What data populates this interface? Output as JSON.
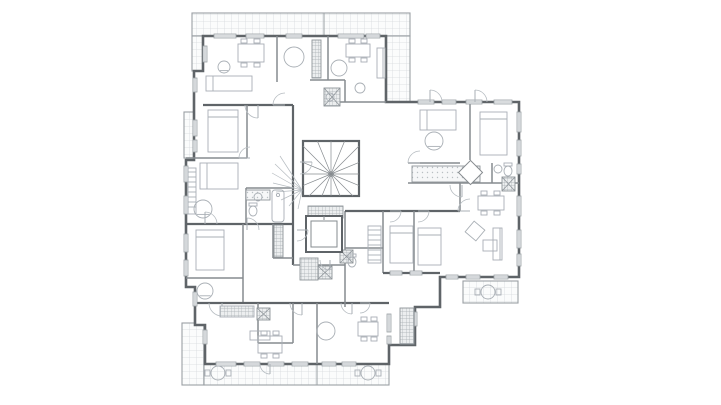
{
  "meta": {
    "title": "Residential apartment building floor plan",
    "drawing_type": "architectural-floor-plan",
    "visible_text": []
  },
  "canvas": {
    "width": 721,
    "height": 405,
    "background": "#ffffff"
  },
  "colors": {
    "outer_wall": "#5f6468",
    "inner_wall": "#868b8f",
    "light_line": "#b6bcc1",
    "furniture": "#a9afb5",
    "hatch_line": "#d6dadd",
    "hatch_border": "#9aa0a4",
    "dark_tile": "#8f959a",
    "window_fill": "#eef1f2",
    "background": "#ffffff"
  },
  "plan": {
    "envelope": [
      [
        203,
        36
      ],
      [
        386,
        36
      ],
      [
        386,
        102
      ],
      [
        519,
        102
      ],
      [
        519,
        277
      ],
      [
        440,
        277
      ],
      [
        440,
        307
      ],
      [
        415,
        307
      ],
      [
        415,
        345
      ],
      [
        389,
        345
      ],
      [
        389,
        364
      ],
      [
        205,
        364
      ],
      [
        205,
        325
      ],
      [
        195,
        325
      ],
      [
        195,
        287
      ],
      [
        186,
        287
      ],
      [
        186,
        160
      ],
      [
        194,
        160
      ],
      [
        194,
        71
      ],
      [
        203,
        71
      ]
    ],
    "terraces": [
      {
        "x": 192,
        "y": 13,
        "w": 218,
        "h": 23,
        "name": "roof-terrace-top"
      },
      {
        "x": 386,
        "y": 36,
        "w": 24,
        "h": 66,
        "name": "roof-terrace-top-right"
      },
      {
        "x": 192,
        "y": 36,
        "w": 11,
        "h": 35,
        "name": "terrace-left-upper"
      },
      {
        "x": 184,
        "y": 112,
        "w": 10,
        "h": 46,
        "name": "terrace-left-mid"
      },
      {
        "x": 182,
        "y": 323,
        "w": 22,
        "h": 62,
        "name": "terrace-bottom-left"
      },
      {
        "x": 204,
        "y": 364,
        "w": 185,
        "h": 21,
        "name": "terrace-bottom"
      },
      {
        "x": 463,
        "y": 281,
        "w": 55,
        "h": 22,
        "name": "balcony-right-wing"
      }
    ],
    "terrace_dividers": [
      [
        324,
        13,
        324,
        36
      ],
      [
        317,
        364,
        317,
        385
      ]
    ],
    "inner_walls": [
      {
        "s": [
          277,
          36,
          277,
          82
        ]
      },
      {
        "s": [
          328,
          36,
          328,
          80
        ]
      },
      {
        "s": [
          310,
          80,
          345,
          80
        ]
      },
      {
        "s": [
          345,
          80,
          345,
          102
        ]
      },
      {
        "s": [
          335,
          102,
          386,
          102
        ]
      },
      {
        "s": [
          203,
          105,
          293,
          105
        ],
        "t": 2.2
      },
      {
        "s": [
          247,
          105,
          247,
          158
        ]
      },
      {
        "s": [
          186,
          158,
          247,
          158
        ]
      },
      {
        "s": [
          293,
          105,
          293,
          265
        ],
        "t": 2.2
      },
      {
        "s": [
          186,
          224,
          293,
          224
        ],
        "t": 2.2
      },
      {
        "s": [
          246,
          188,
          246,
          224
        ]
      },
      {
        "s": [
          246,
          188,
          293,
          188
        ]
      },
      {
        "s": [
          273,
          224,
          273,
          258
        ]
      },
      {
        "s": [
          273,
          258,
          293,
          258
        ]
      },
      {
        "s": [
          243,
          224,
          243,
          303
        ]
      },
      {
        "s": [
          186,
          278,
          243,
          278
        ]
      },
      {
        "s": [
          195,
          303,
          389,
          303
        ],
        "t": 2.2
      },
      {
        "s": [
          317,
          303,
          317,
          364
        ]
      },
      {
        "s": [
          258,
          303,
          258,
          343
        ]
      },
      {
        "s": [
          258,
          343,
          293,
          343
        ]
      },
      {
        "s": [
          293,
          303,
          293,
          343
        ]
      },
      {
        "s": [
          345,
          211,
          345,
          307
        ]
      },
      {
        "s": [
          293,
          265,
          345,
          265
        ]
      },
      {
        "s": [
          345,
          211,
          460,
          211
        ],
        "t": 2.2
      },
      {
        "s": [
          460,
          183,
          460,
          211
        ]
      },
      {
        "s": [
          408,
          163,
          460,
          163
        ]
      },
      {
        "s": [
          408,
          183,
          519,
          183
        ]
      },
      {
        "s": [
          492,
          163,
          492,
          183
        ]
      },
      {
        "s": [
          470,
          102,
          470,
          160
        ]
      },
      {
        "s": [
          414,
          211,
          414,
          273
        ]
      },
      {
        "s": [
          383,
          211,
          383,
          273
        ]
      },
      {
        "s": [
          383,
          273,
          440,
          273
        ],
        "t": 2.2
      },
      {
        "s": [
          345,
          248,
          383,
          248
        ]
      }
    ],
    "stair": {
      "x": 303,
      "y": 141,
      "w": 56,
      "h": 55,
      "hubx": 331,
      "huby": 174,
      "steps": 16
    },
    "sketch_fan": {
      "from": [
        302,
        190
      ],
      "to": [
        [
          280,
          156
        ],
        [
          275,
          164
        ],
        [
          272,
          173
        ],
        [
          273,
          183
        ],
        [
          276,
          192
        ],
        [
          281,
          200
        ],
        [
          289,
          206
        ],
        [
          298,
          209
        ]
      ]
    },
    "elevator": {
      "x": 306,
      "y": 216,
      "w": 36,
      "h": 36,
      "inset": 5
    },
    "windows": [
      [
        214,
        34,
        22,
        4
      ],
      [
        246,
        34,
        18,
        4
      ],
      [
        286,
        34,
        16,
        4
      ],
      [
        338,
        34,
        26,
        4
      ],
      [
        366,
        34,
        14,
        4
      ],
      [
        418,
        100,
        16,
        4
      ],
      [
        442,
        100,
        14,
        4
      ],
      [
        466,
        100,
        16,
        4
      ],
      [
        494,
        100,
        18,
        4
      ],
      [
        517,
        112,
        4,
        20
      ],
      [
        517,
        140,
        4,
        16
      ],
      [
        517,
        164,
        4,
        10
      ],
      [
        517,
        196,
        4,
        20
      ],
      [
        517,
        230,
        4,
        18
      ],
      [
        517,
        254,
        4,
        12
      ],
      [
        446,
        275,
        12,
        4
      ],
      [
        466,
        275,
        14,
        4
      ],
      [
        494,
        275,
        14,
        4
      ],
      [
        390,
        271,
        12,
        4
      ],
      [
        410,
        271,
        12,
        4
      ],
      [
        216,
        362,
        20,
        4
      ],
      [
        244,
        362,
        16,
        4
      ],
      [
        268,
        362,
        16,
        4
      ],
      [
        292,
        362,
        16,
        4
      ],
      [
        322,
        362,
        14,
        4
      ],
      [
        342,
        362,
        14,
        4
      ],
      [
        184,
        166,
        4,
        16
      ],
      [
        184,
        196,
        4,
        18
      ],
      [
        184,
        234,
        4,
        18
      ],
      [
        184,
        260,
        4,
        16
      ],
      [
        193,
        292,
        4,
        14
      ],
      [
        193,
        78,
        4,
        14
      ],
      [
        193,
        120,
        4,
        16
      ],
      [
        193,
        140,
        4,
        12
      ],
      [
        203,
        330,
        4,
        14
      ],
      [
        203,
        46,
        4,
        16
      ],
      [
        387,
        314,
        4,
        18
      ],
      [
        387,
        336,
        4,
        8
      ],
      [
        413,
        312,
        4,
        14
      ]
    ],
    "dark_tiles": [
      {
        "x": 312,
        "y": 40,
        "w": 9,
        "h": 38
      },
      {
        "x": 324,
        "y": 88,
        "w": 16,
        "h": 18,
        "cross": true
      },
      {
        "x": 308,
        "y": 206,
        "w": 35,
        "h": 12
      },
      {
        "x": 300,
        "y": 258,
        "w": 18,
        "h": 22
      },
      {
        "x": 318,
        "y": 266,
        "w": 14,
        "h": 13,
        "cross": true
      },
      {
        "x": 274,
        "y": 225,
        "w": 9,
        "h": 32
      },
      {
        "x": 340,
        "y": 250,
        "w": 13,
        "h": 13,
        "cross": true
      },
      {
        "x": 502,
        "y": 177,
        "w": 13,
        "h": 14,
        "cross": true
      },
      {
        "x": 257,
        "y": 308,
        "w": 13,
        "h": 12,
        "cross": true
      },
      {
        "x": 400,
        "y": 308,
        "w": 14,
        "h": 36
      },
      {
        "x": 412,
        "y": 166,
        "w": 68,
        "h": 16,
        "light": true
      },
      {
        "x": 246,
        "y": 190,
        "w": 24,
        "h": 10,
        "light": true
      }
    ],
    "doors": [
      [
        258,
        105,
        13,
        90
      ],
      [
        285,
        105,
        12,
        180
      ],
      [
        300,
        162,
        12,
        0
      ],
      [
        247,
        230,
        12,
        270
      ],
      [
        297,
        230,
        11,
        0
      ],
      [
        222,
        303,
        13,
        90
      ],
      [
        302,
        303,
        12,
        90
      ],
      [
        352,
        303,
        11,
        90
      ],
      [
        420,
        163,
        12,
        180
      ],
      [
        462,
        185,
        12,
        90
      ],
      [
        470,
        211,
        12,
        180
      ],
      [
        390,
        211,
        11,
        0
      ],
      [
        418,
        211,
        11,
        0
      ],
      [
        250,
        158,
        11,
        180
      ],
      [
        205,
        224,
        12,
        270
      ],
      [
        330,
        260,
        10,
        90
      ],
      [
        475,
        102,
        12,
        270
      ],
      [
        430,
        102,
        12,
        270
      ],
      [
        360,
        303,
        10,
        0
      ],
      [
        270,
        364,
        10,
        90
      ]
    ],
    "furniture": [
      {
        "t": "dining",
        "x": 238,
        "y": 44,
        "w": 26,
        "h": 18
      },
      {
        "t": "chair-round",
        "x": 224,
        "y": 67,
        "r": 6
      },
      {
        "t": "bed-h",
        "x": 206,
        "y": 76,
        "w": 46,
        "h": 15
      },
      {
        "t": "round",
        "x": 294,
        "y": 57,
        "r": 10
      },
      {
        "t": "dining",
        "x": 346,
        "y": 44,
        "w": 24,
        "h": 13
      },
      {
        "t": "round",
        "x": 339,
        "y": 68,
        "r": 8
      },
      {
        "t": "sofa-v",
        "x": 377,
        "y": 48,
        "w": 8,
        "h": 30
      },
      {
        "t": "round",
        "x": 360,
        "y": 88,
        "r": 5
      },
      {
        "t": "bed-v",
        "x": 208,
        "y": 110,
        "w": 30,
        "h": 42
      },
      {
        "t": "bed-h",
        "x": 200,
        "y": 163,
        "w": 38,
        "h": 26
      },
      {
        "t": "ward-v",
        "x": 188,
        "y": 168,
        "w": 8,
        "h": 46
      },
      {
        "t": "chair-round",
        "x": 203,
        "y": 209,
        "r": 9
      },
      {
        "t": "tub",
        "x": 272,
        "y": 190,
        "w": 12,
        "h": 32
      },
      {
        "t": "wc",
        "x": 253,
        "y": 211,
        "r": 5
      },
      {
        "t": "sink",
        "x": 258,
        "y": 197,
        "r": 4
      },
      {
        "t": "bed-v",
        "x": 196,
        "y": 230,
        "w": 28,
        "h": 40
      },
      {
        "t": "chair-round",
        "x": 205,
        "y": 291,
        "r": 8
      },
      {
        "t": "grid-rect",
        "x": 220,
        "y": 306,
        "w": 34,
        "h": 11
      },
      {
        "t": "island",
        "x": 250,
        "y": 331,
        "w": 20,
        "h": 9
      },
      {
        "t": "dining",
        "x": 258,
        "y": 336,
        "w": 24,
        "h": 17
      },
      {
        "t": "round",
        "x": 326,
        "y": 331,
        "r": 9
      },
      {
        "t": "dining",
        "x": 358,
        "y": 322,
        "w": 20,
        "h": 14
      },
      {
        "t": "patio",
        "x": 218,
        "y": 373,
        "r": 7
      },
      {
        "t": "patio",
        "x": 368,
        "y": 373,
        "r": 7
      },
      {
        "t": "patio",
        "x": 488,
        "y": 292,
        "r": 7
      },
      {
        "t": "ward-v",
        "x": 368,
        "y": 226,
        "w": 13,
        "h": 37
      },
      {
        "t": "bed-v",
        "x": 390,
        "y": 226,
        "w": 23,
        "h": 37
      },
      {
        "t": "bed-v",
        "x": 418,
        "y": 228,
        "w": 23,
        "h": 37
      },
      {
        "t": "wc",
        "x": 352,
        "y": 262,
        "r": 5
      },
      {
        "t": "bed-h",
        "x": 420,
        "y": 110,
        "w": 36,
        "h": 20
      },
      {
        "t": "chair-round",
        "x": 434,
        "y": 141,
        "r": 9
      },
      {
        "t": "bed-v",
        "x": 480,
        "y": 112,
        "w": 27,
        "h": 43
      },
      {
        "t": "wc",
        "x": 508,
        "y": 171,
        "r": 5
      },
      {
        "t": "sink",
        "x": 498,
        "y": 169,
        "r": 4
      },
      {
        "t": "dining",
        "x": 478,
        "y": 196,
        "w": 26,
        "h": 14
      },
      {
        "t": "arm-diag",
        "x": 468,
        "y": 224,
        "w": 14,
        "h": 14
      },
      {
        "t": "coffee",
        "x": 483,
        "y": 240,
        "w": 14,
        "h": 11
      },
      {
        "t": "sofa-v",
        "x": 493,
        "y": 228,
        "w": 9,
        "h": 32
      },
      {
        "t": "sink",
        "x": 330,
        "y": 97,
        "r": 4
      },
      {
        "t": "diamond",
        "x": 462,
        "y": 164,
        "w": 17,
        "h": 17
      }
    ]
  }
}
